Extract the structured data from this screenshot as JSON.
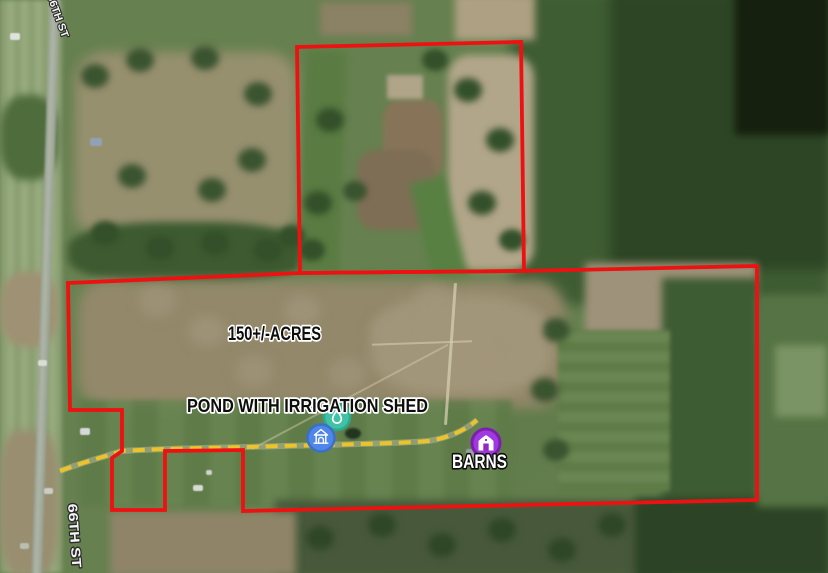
{
  "map": {
    "property": {
      "acres_label": "150+/-ACRES",
      "pond_label": "POND WITH IRRIGATION SHED",
      "barns_label": "BARNS"
    },
    "streets": {
      "top": "66TH ST",
      "bottom": "66TH ST"
    },
    "markers": {
      "pond": {
        "name": "pond-marker",
        "icon": "water-drop-icon"
      },
      "shed": {
        "name": "irrigation-shed-marker",
        "icon": "shed-icon"
      },
      "barns": {
        "name": "barns-marker",
        "icon": "barn-icon"
      }
    },
    "colors": {
      "boundary": "#ee1111",
      "trail": "#edc32c",
      "pond_marker": "#41c2a4",
      "shed_marker": "#4f86e8",
      "barns_marker": "#a139e0"
    }
  }
}
